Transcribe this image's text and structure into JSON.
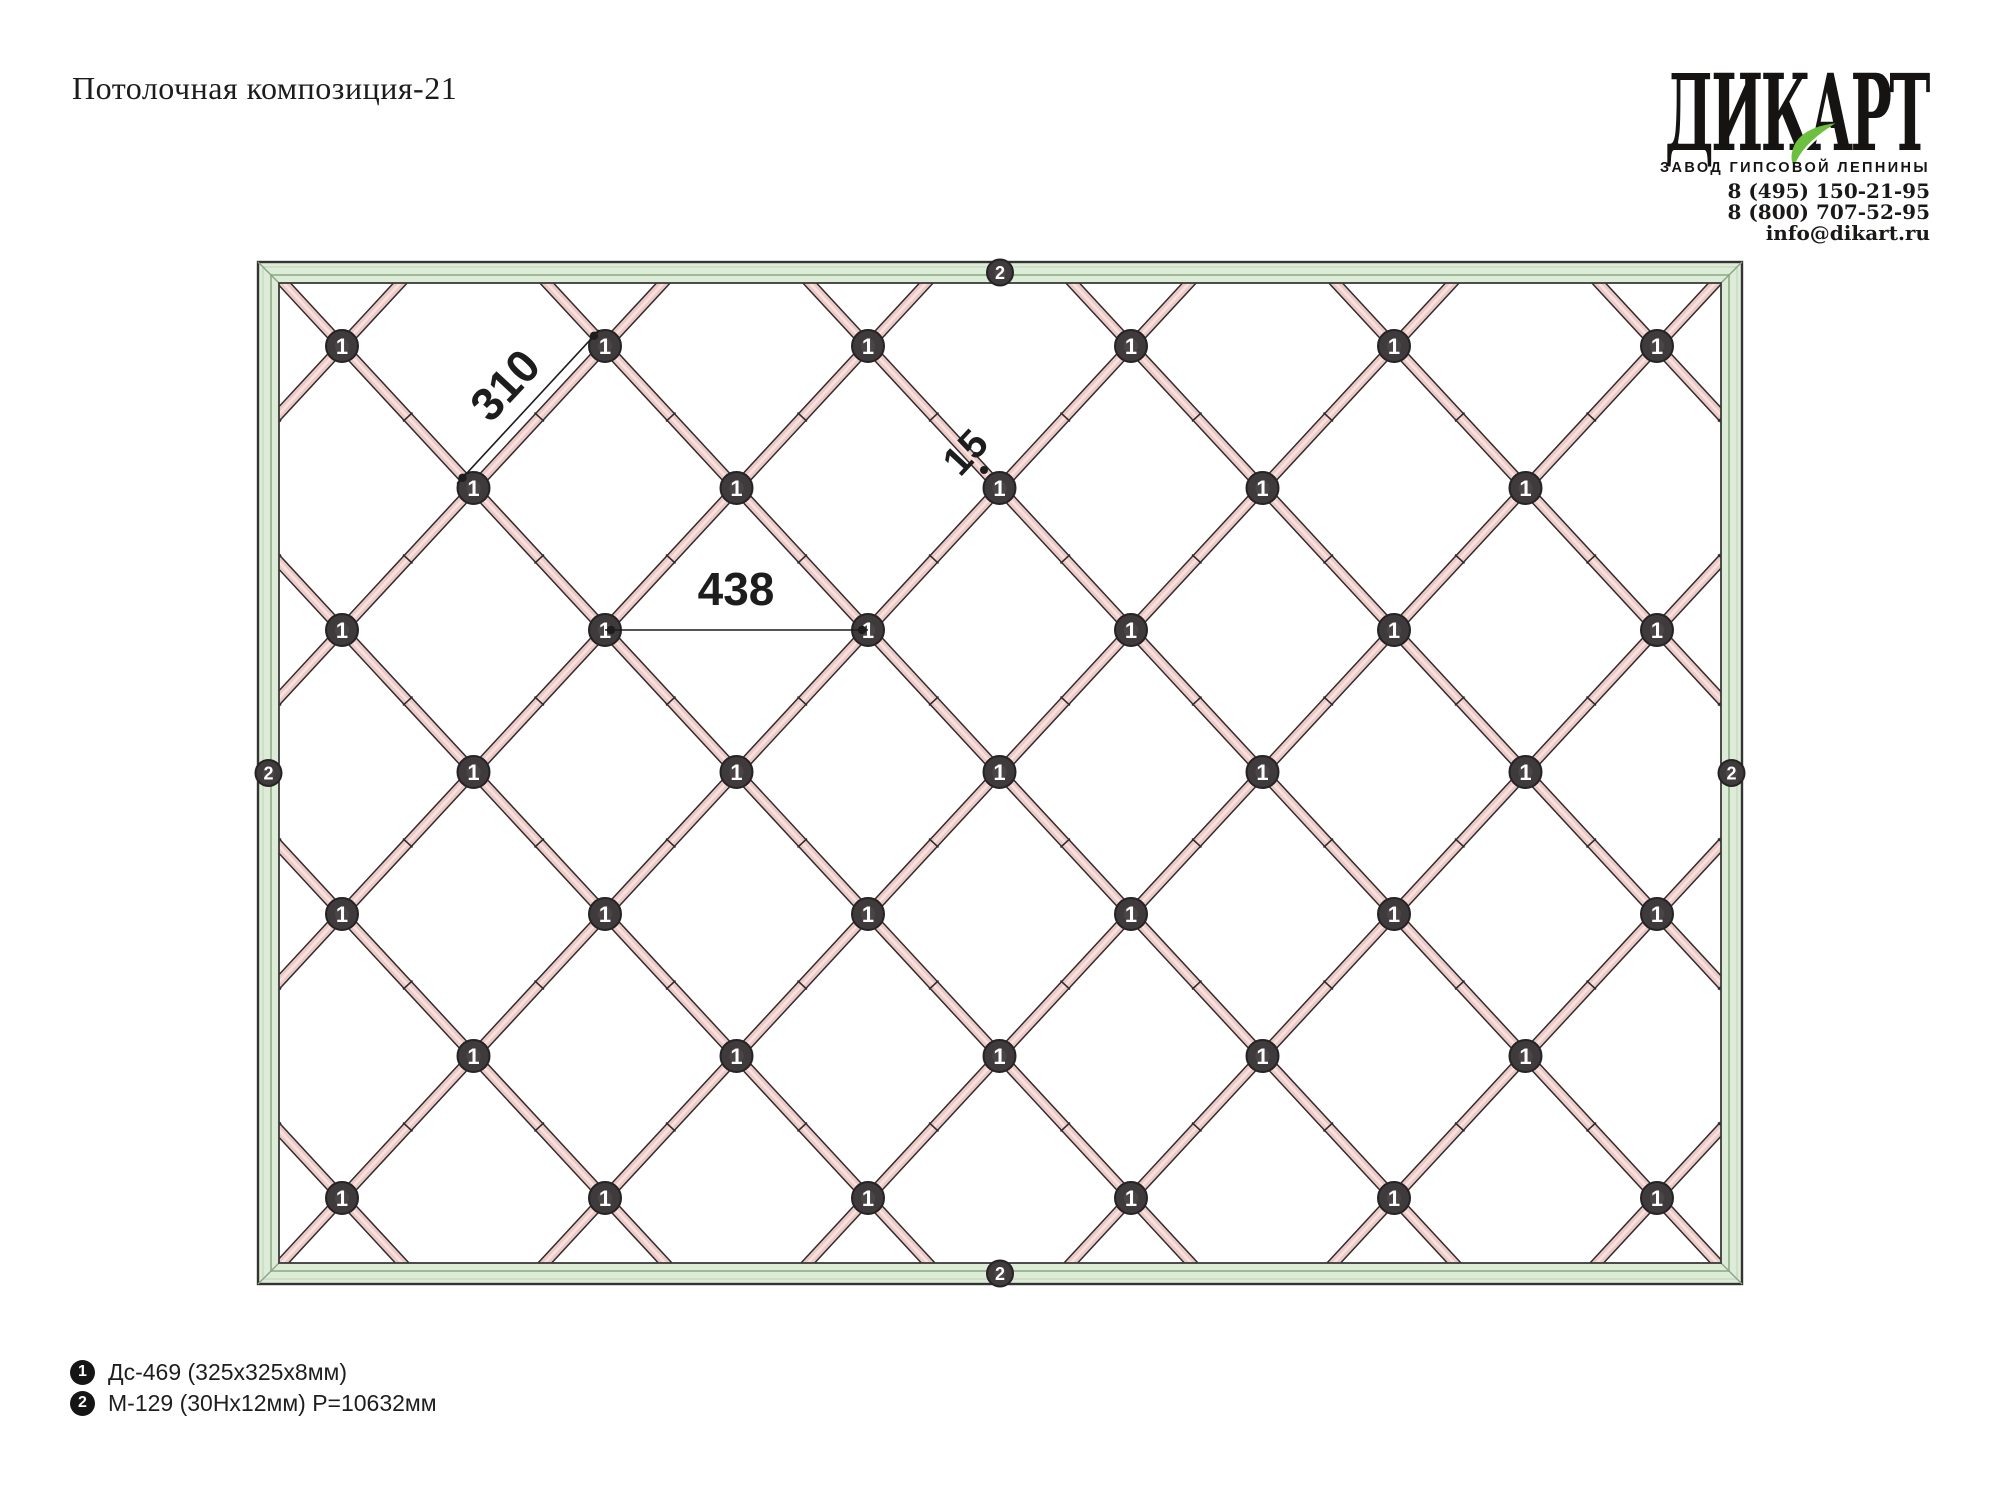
{
  "title": "Потолочная композиция-21",
  "logo": {
    "brand": "ДИКАРТ",
    "tagline": "ЗАВОД ГИПСОВОЙ ЛЕПНИНЫ",
    "phone_1": "8 (495) 150-21-95",
    "phone_2": "8 (800) 707-52-95",
    "email": "info@dikart.ru",
    "leaf_color": "#6cbf3f"
  },
  "legend": {
    "items": [
      {
        "marker": "1",
        "label": "Дс-469 (325x325x8мм)"
      },
      {
        "marker": "2",
        "label": "М-129 (30Нх12мм) Р=10632мм"
      }
    ]
  },
  "drawing": {
    "node_marker": "1",
    "frame_marker": "2",
    "dimensions": {
      "diagonal_spacing": "310",
      "horizontal_spacing": "438",
      "joint_gap": "15"
    },
    "frame": {
      "x": 258,
      "y": 262,
      "w": 1484,
      "h": 1022,
      "thickness": 21
    },
    "lattice": {
      "origin_x": 342,
      "origin_y": 346,
      "step_x": 263,
      "half_step_y": 142,
      "rows": 7,
      "cols_even": 6,
      "cols_odd": 5
    },
    "colors": {
      "frame_fill": "#ddecd7",
      "frame_line_dark": "#343434",
      "frame_line_mid": "#9fb897",
      "frame_line_light": "#c6d8be",
      "frame_miter": "#8aa182",
      "strap_outline": "#2f2c2d",
      "strap_fill": "#efc9c5",
      "strap_highlight": "#f8e3e1",
      "badge_fill": "#3f3a3c",
      "badge_inner": "#4a4446",
      "badge_ring": "#262324",
      "badge_text": "#ffffff",
      "dim_color": "#1d1d1d"
    }
  }
}
